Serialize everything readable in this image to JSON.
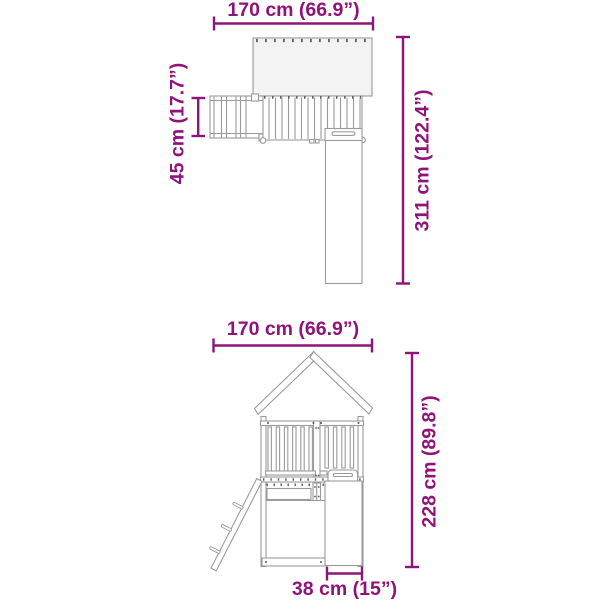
{
  "colors": {
    "dimension": "#901379",
    "line_gray": "#9b9b9b",
    "roof_fill": "#f3f3f3",
    "background": "#ffffff"
  },
  "views": {
    "top": {
      "width_label": "170 cm (66.9”)",
      "depth_label": "45 cm (17.7”)",
      "length_label": "311 cm (122.4”)"
    },
    "front": {
      "width_label": "170 cm (66.9”)",
      "height_label": "228 cm (89.8”)",
      "slide_width_label": "38 cm (15”)"
    }
  }
}
